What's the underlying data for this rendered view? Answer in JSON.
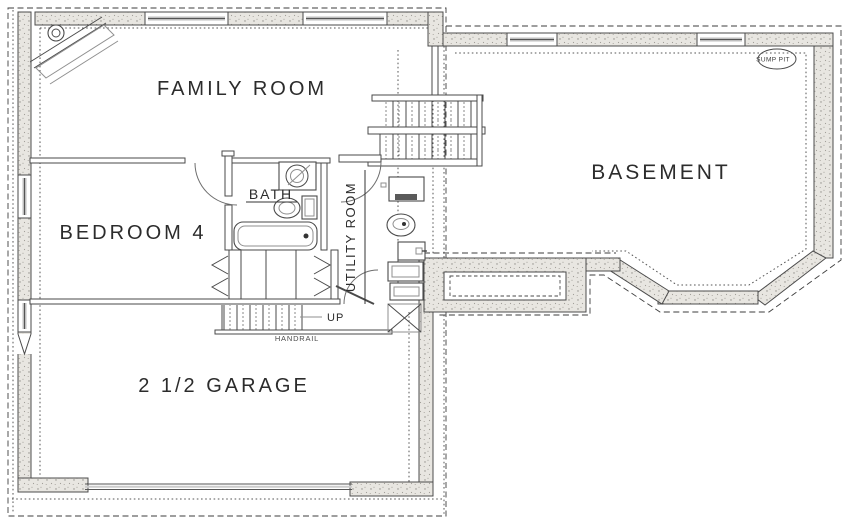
{
  "drawing": {
    "type": "architectural-floor-plan",
    "level": "basement / lower level"
  },
  "labels": {
    "family_room": "FAMILY ROOM",
    "basement": "BASEMENT",
    "bedroom4": "BEDROOM 4",
    "bath": "BATH",
    "utility_room": "UTILITY ROOM",
    "garage": "2 1/2 GARAGE",
    "up": "UP",
    "handrail": "HANDRAIL",
    "sump_pit": "SUMP PIT"
  },
  "colors": {
    "background": "#ffffff",
    "line": "#4a4a4a",
    "dashed_line": "#3e3e3e",
    "wall_fill": "#e8e6e1",
    "wall_speckle": "#8f8d88",
    "text": "#2c2c2c"
  },
  "icons": {
    "fireplace": "corner-fireplace-icon",
    "sump_pit_marker": "sump-pit-ellipse-icon",
    "floor_drain_marker": "x-box-icon"
  }
}
